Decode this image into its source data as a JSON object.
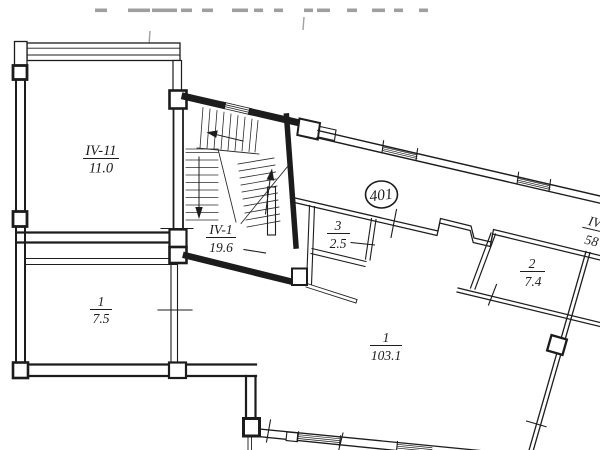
{
  "drawing": {
    "type": "architectural floor plan",
    "unit": {
      "number": "401"
    },
    "rooms": {
      "iv11": {
        "label": "IV-11",
        "area": "11.0"
      },
      "iv1": {
        "label": "IV-1",
        "area": "19.6"
      },
      "one_75": {
        "label": "1",
        "area": "7.5"
      },
      "three_25": {
        "label": "3",
        "area": "2.5"
      },
      "two_74": {
        "label": "2",
        "area": "7.4"
      },
      "one_1031": {
        "label": "1",
        "area": "103.1"
      },
      "iv_partial": {
        "label": "IV",
        "area": "58"
      }
    },
    "colors": {
      "ink": "#1c1c1c",
      "faint": "#9f9f9f",
      "background": "#ffffff"
    }
  }
}
